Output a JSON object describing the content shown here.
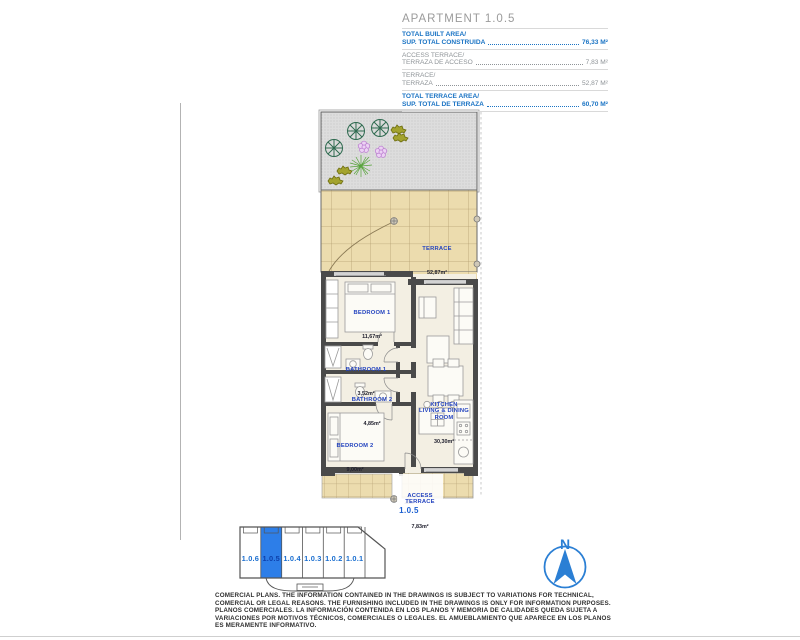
{
  "header": {
    "title": "APARTMENT 1.0.5",
    "rows": [
      {
        "label_en": "TOTAL BUILT AREA/",
        "label_es": "SUP. TOTAL CONSTRUIDA",
        "value": "76,33 M²"
      },
      {
        "label_en": "ACCESS TERRACE/",
        "label_es": "TERRAZA DE ACCESO",
        "value": "7,83 M²"
      },
      {
        "label_en": "TERRACE/",
        "label_es": "TERRAZA",
        "value": "52,87 M²"
      },
      {
        "label_en": "TOTAL TERRACE AREA/",
        "label_es": "SUP. TOTAL DE TERRAZA",
        "value": "60,70 M²"
      }
    ]
  },
  "floorplan": {
    "rooms": {
      "terrace": {
        "name": "TERRACE",
        "area": "52,87m²"
      },
      "bedroom1": {
        "name": "BEDROOM 1",
        "area": "11,67m²"
      },
      "bathroom1": {
        "name": "BATHROOM 1",
        "area": "3,52m²"
      },
      "bathroom2": {
        "name": "BATHROOM 2",
        "area": "4,85m²"
      },
      "bedroom2": {
        "name": "BEDROOM 2",
        "area": "9,00m²"
      },
      "kitchen": {
        "name": "KITCHEN\nLIVING & DINING\nROOM",
        "area": "30,30m²"
      },
      "access_terrace": {
        "name": "ACCESS\nTERRACE",
        "area": "7,83m²"
      }
    },
    "unit_label": "1.0.5"
  },
  "keyplan": {
    "units": [
      {
        "label": "1.0.6",
        "highlighted": false
      },
      {
        "label": "1.0.5",
        "highlighted": true
      },
      {
        "label": "1.0.4",
        "highlighted": false
      },
      {
        "label": "1.0.3",
        "highlighted": false
      },
      {
        "label": "1.0.2",
        "highlighted": false
      },
      {
        "label": "1.0.1",
        "highlighted": false
      }
    ]
  },
  "compass": {
    "label": "N"
  },
  "disclaimer": {
    "lines": [
      "COMERCIAL PLANS. THE INFORMATION CONTAINED IN THE DRAWINGS IS SUBJECT TO VARIATIONS FOR TECHNICAL,",
      "COMERCIAL OR LEGAL REASONS. THE FURNISHING INCLUDED IN THE DRAWINGS IS ONLY FOR INFORMATION PURPOSES.",
      "PLANOS COMERCIALES. LA INFORMACIÓN CONTENIDA EN LOS PLANOS Y MEMORIA DE CALIDADES QUEDA SUJETA A",
      "VARIACIONES POR MOTIVOS TÉCNICOS, COMERCIALES O LEGALES. EL AMUEBLAMIENTO QUE APARECE EN LOS PLANOS",
      "ES MERAMENTE INFORMATIVO."
    ]
  },
  "colors": {
    "accent_blue": "#1b74c4",
    "room_label_blue": "#2343bf",
    "keyplan_highlight": "#2d7ee8",
    "compass_blue": "#2b7fd4",
    "wall_gray": "#4a4a4a",
    "terrace_beige": "#ecdcae",
    "muted_gray": "#8f9498"
  }
}
